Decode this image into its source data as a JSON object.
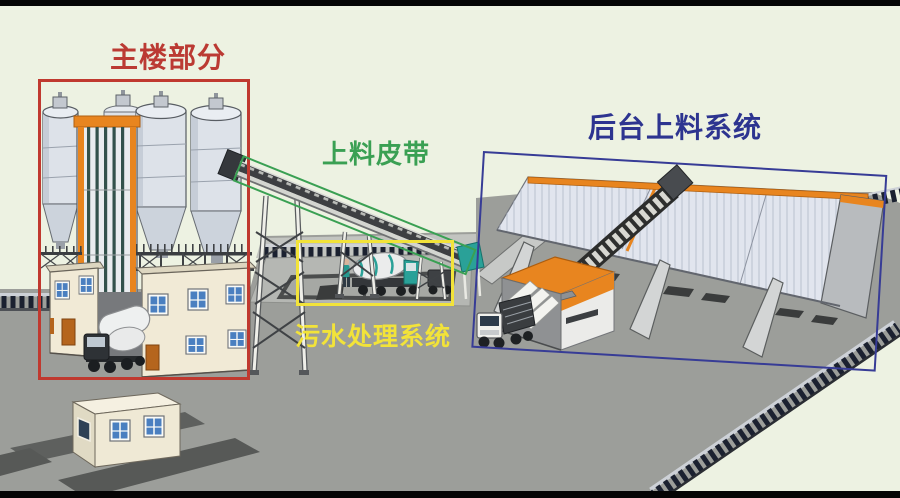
{
  "annotations": {
    "main_building": {
      "label": "主楼部分"
    },
    "feeding_belt": {
      "label": "上料皮带"
    },
    "sewage_treatment": {
      "label": "污水处理系统"
    },
    "backend_feeding": {
      "label": "后台上料系统"
    }
  },
  "colors": {
    "annotation_red": "#c0392f",
    "annotation_green": "#3aa053",
    "annotation_yellow": "#f2e33a",
    "annotation_blue": "#373c96",
    "label_red": "#bb3a33",
    "label_green": "#3aa053",
    "label_yellow": "#f2e339",
    "label_blue": "#2d3490",
    "background": "#edf2e2",
    "ground": "#9c9e9a",
    "accent_orange": "#e8851f"
  }
}
